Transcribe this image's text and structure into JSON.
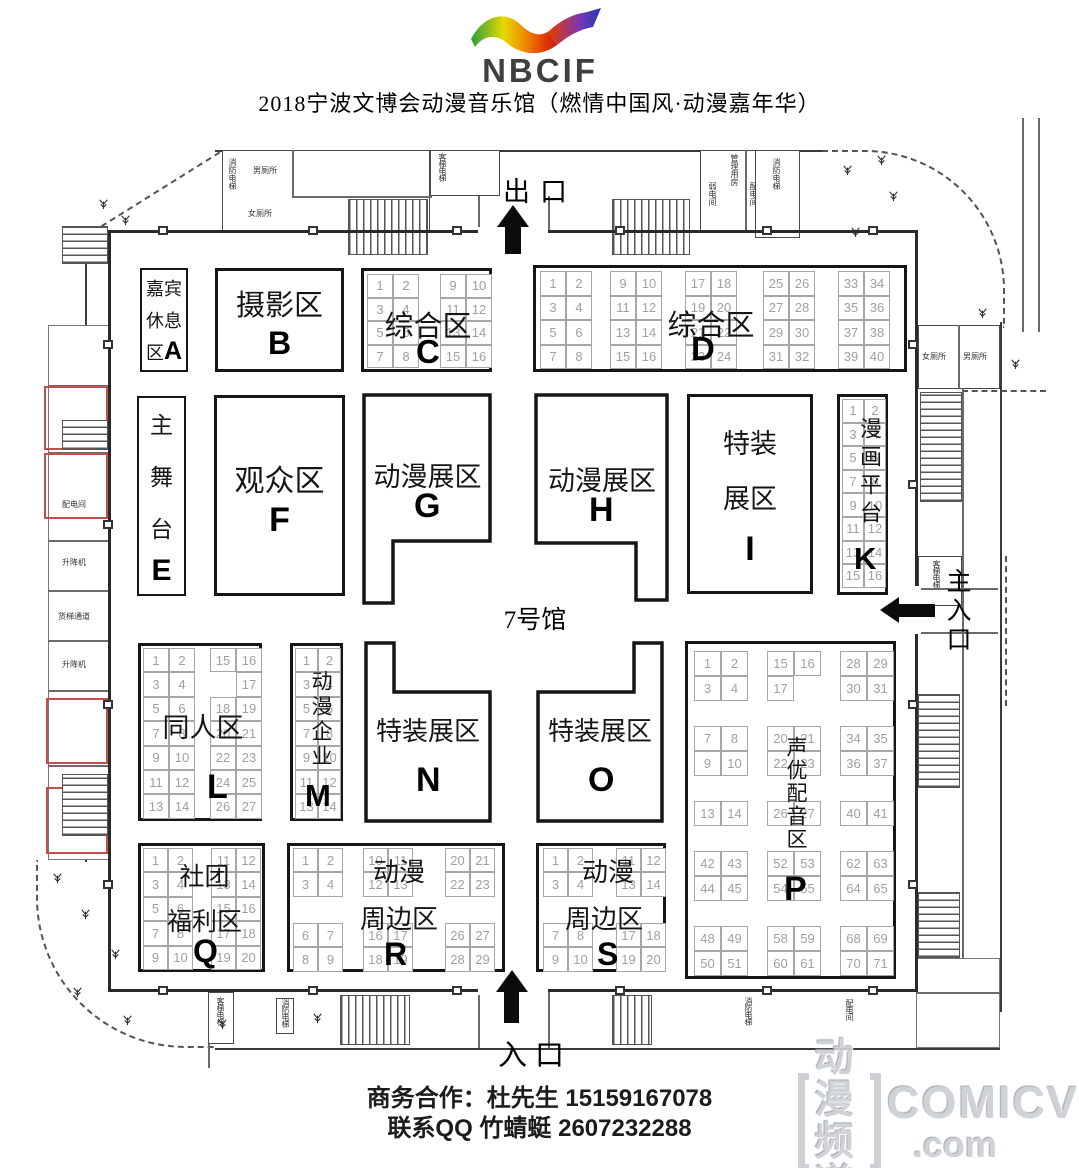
{
  "header": {
    "logo": {
      "text": "NBCIF"
    },
    "title": "2018宁波文博会动漫音乐馆（燃情中国风·动漫嘉年华）"
  },
  "hall": {
    "label": "7号馆"
  },
  "gates": {
    "exit": "出口",
    "main_entrance": "主入口",
    "entrance": "入口"
  },
  "zones": {
    "A": {
      "id": "A",
      "lines": [
        "嘉宾",
        "休息",
        "区"
      ]
    },
    "B": {
      "id": "B",
      "name": "摄影区"
    },
    "C": {
      "id": "C",
      "name": "综合区",
      "left": [
        1,
        2,
        3,
        4,
        5,
        6,
        7,
        8
      ],
      "right": [
        9,
        10,
        11,
        12,
        13,
        14,
        15,
        16
      ]
    },
    "D": {
      "id": "D",
      "name": "综合区",
      "blocks": [
        [
          1,
          2,
          3,
          4,
          5,
          6,
          7,
          8
        ],
        [
          9,
          10,
          11,
          12,
          13,
          14,
          15,
          16
        ],
        [
          17,
          18,
          19,
          20,
          21,
          22,
          23,
          24
        ],
        [
          25,
          26,
          27,
          28,
          29,
          30,
          31,
          32
        ],
        [
          33,
          34,
          35,
          36,
          37,
          38,
          39,
          40
        ]
      ]
    },
    "E": {
      "id": "E",
      "lines": [
        "主",
        "舞",
        "台"
      ]
    },
    "F": {
      "id": "F",
      "name": "观众区"
    },
    "G": {
      "id": "G",
      "name": "动漫展区"
    },
    "H": {
      "id": "H",
      "name": "动漫展区"
    },
    "I": {
      "id": "I",
      "lines": [
        "特装",
        "展区"
      ]
    },
    "K": {
      "id": "K",
      "name": "漫画平台",
      "booths": [
        1,
        2,
        3,
        4,
        5,
        6,
        7,
        8,
        9,
        10,
        11,
        12,
        13,
        14,
        15,
        16
      ]
    },
    "L": {
      "id": "L",
      "name": "同人区",
      "left": [
        1,
        2,
        3,
        4,
        5,
        6,
        7,
        8,
        9,
        10,
        11,
        12,
        13,
        14
      ],
      "right": [
        15,
        16,
        null,
        17,
        18,
        19,
        20,
        21,
        22,
        23,
        24,
        25,
        26,
        27
      ]
    },
    "M": {
      "id": "M",
      "name": "动漫企业",
      "booths": [
        1,
        2,
        3,
        4,
        5,
        6,
        7,
        8,
        9,
        10,
        11,
        12,
        13,
        14
      ]
    },
    "N": {
      "id": "N",
      "name": "特装展区"
    },
    "O": {
      "id": "O",
      "name": "特装展区"
    },
    "P": {
      "id": "P",
      "name": "声优配音区",
      "blocks": [
        [
          1,
          2,
          3,
          4
        ],
        [
          15,
          16,
          17,
          null
        ],
        [
          28,
          29,
          30,
          31
        ],
        [
          7,
          8,
          9,
          10
        ],
        [
          20,
          21,
          22,
          23
        ],
        [
          34,
          35,
          36,
          37
        ],
        [
          13,
          14
        ],
        [
          26,
          27
        ],
        [
          40,
          41
        ],
        [
          42,
          43,
          44,
          45
        ],
        [
          52,
          53,
          54,
          55
        ],
        [
          62,
          63,
          64,
          65
        ],
        [
          48,
          49,
          50,
          51
        ],
        [
          58,
          59,
          60,
          61
        ],
        [
          68,
          69,
          70,
          71
        ]
      ]
    },
    "Q": {
      "id": "Q",
      "lines": [
        "社团",
        "福利区"
      ],
      "left": [
        1,
        2,
        3,
        4,
        5,
        6,
        7,
        8,
        9,
        10
      ],
      "right": [
        11,
        12,
        13,
        14,
        15,
        16,
        17,
        18,
        19,
        20
      ]
    },
    "R": {
      "id": "R",
      "lines": [
        "动漫",
        "周边区"
      ],
      "blocks": [
        [
          1,
          2,
          3,
          4
        ],
        [
          10,
          11,
          12,
          13
        ],
        [
          20,
          21,
          22,
          23
        ],
        [
          6,
          7,
          8,
          9
        ],
        [
          16,
          17,
          18,
          19
        ],
        [
          26,
          27,
          28,
          29
        ]
      ]
    },
    "S": {
      "id": "S",
      "lines": [
        "动漫",
        "周边区"
      ],
      "blocks": [
        [
          1,
          2,
          3,
          4
        ],
        [
          11,
          12,
          13,
          14
        ],
        [
          7,
          8,
          9,
          10
        ],
        [
          17,
          18,
          19,
          20
        ]
      ]
    }
  },
  "facilities": {
    "mens_toilet": "男厕所",
    "womens_toilet": "女厕所",
    "fire_elevator": "消防电梯",
    "passenger_elevator": "客梯电梯",
    "management_room": "管理用房",
    "weak_current_room": "弱电间",
    "power_room": "配电间",
    "lift": "升降机",
    "freight_passage": "货梯通道"
  },
  "footer": {
    "contact_line1": "商务合作：杜先生 15159167078",
    "contact_line2": "联系QQ 竹蜻蜓 2607232288",
    "watermark": {
      "cn_top": "动漫",
      "cn_bottom": "频道",
      "en": "COMICV",
      "domain": ".com"
    }
  }
}
